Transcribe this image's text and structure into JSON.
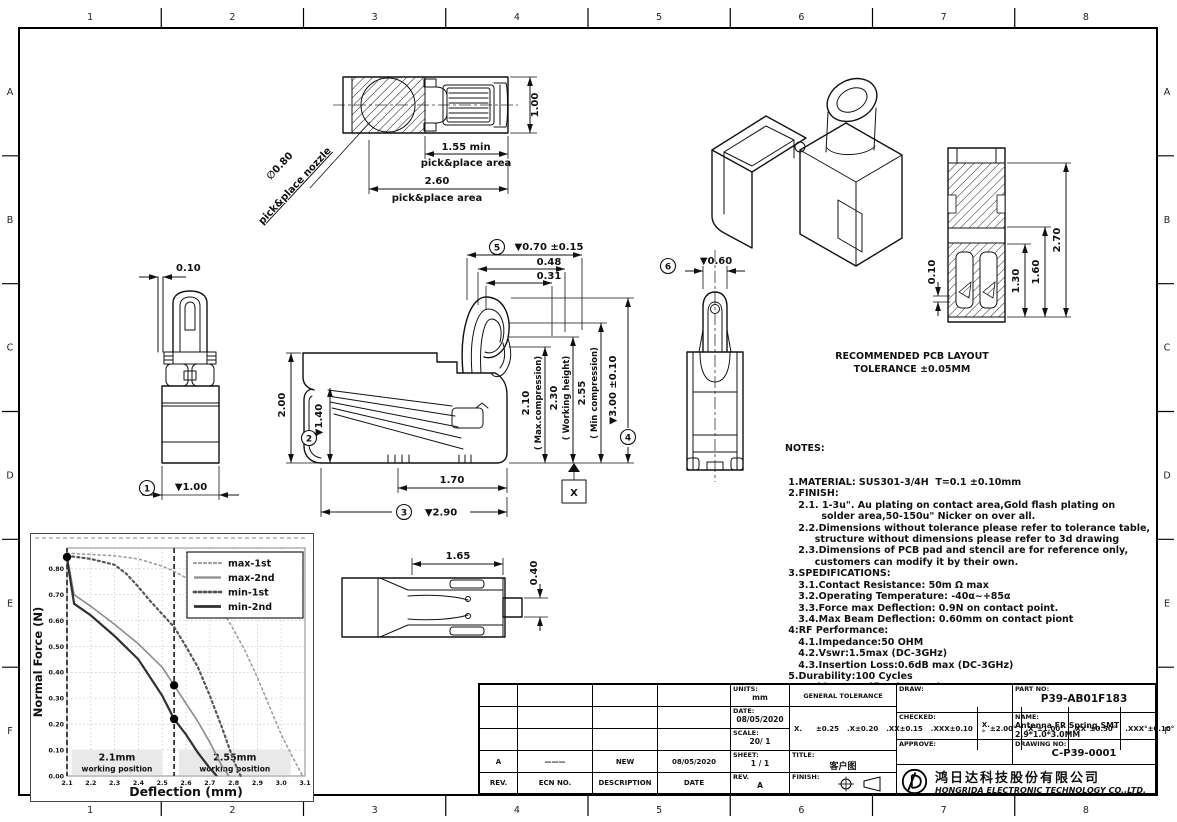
{
  "sheet": {
    "zone_cols": [
      "1",
      "2",
      "3",
      "4",
      "5",
      "6",
      "7",
      "8"
    ],
    "zone_rows": [
      "A",
      "B",
      "C",
      "D",
      "E",
      "F"
    ]
  },
  "dims": {
    "top_100": "1.00",
    "top_155": "1.55 min",
    "top_area1": "pick&place area",
    "top_260": "2.60",
    "top_area2": "pick&place area",
    "nozzle_dia": "∅0.80",
    "nozzle_label": "pick&place nozzle",
    "front_010": "0.10",
    "front_200": "2.00",
    "front_100": "▼1.00",
    "side_140": "▼1.40",
    "side_170": "1.70",
    "side_290": "▼2.90",
    "side_070": "▼0.70 ±0.15",
    "side_048": "0.48",
    "side_031": "0.31",
    "side_210": "2.10",
    "side_210n": "( Max.compression)",
    "side_230": "2.30",
    "side_230n": "( Working height)",
    "side_255": "2.55",
    "side_255n": "( Min compression)",
    "side_300": "▼3.00 ±0.10",
    "datum_x": "X",
    "back_060": "▼0.60",
    "bot_165": "1.65",
    "bot_040": "0.40",
    "pcb_010": "0.10",
    "pcb_130": "1.30",
    "pcb_160": "1.60",
    "pcb_270": "2.70",
    "b1": "1",
    "b2": "2",
    "b3": "3",
    "b4": "4",
    "b5": "5",
    "b6": "6"
  },
  "pcb_caption": {
    "line1": "RECOMMENDED PCB LAYOUT",
    "line2": "TOLERANCE ±0.05MM"
  },
  "notes": {
    "title": "NOTES:",
    "lines": [
      " 1.MATERIAL: SUS301-3/4H  T=0.1 ±0.10mm",
      " 2.FINISH:",
      "    2.1. 1-3u\". Au plating on contact area,Gold flash plating on",
      "           solder area,50-150u\" Nicker on over all.",
      "    2.2.Dimensions without tolerance please refer to tolerance table,",
      "         structure without dimensions please refer to 3d drawing",
      "    2.3.Dimensions of PCB pad and stencil are for reference only,",
      "         customers can modify it by their own.",
      " 3.SPEDIFICATIONS:",
      "    3.1.Contact Resistance: 50m Ω max",
      "    3.2.Operating Temperature: -40α~+85α",
      "    3.3.Force max Deflection: 0.9N on contact point.",
      "    3.4.Max Beam Deflection: 0.60mm on contact piont",
      " 4:RF Performance:",
      "    4.1.Impedance:50 OHM",
      "    4.2.Vswr:1.5max (DC-3GHz)",
      "    4.3.Insertion Loss:0.6dB max (DC-3GHz)",
      " 5.Durability:100 Cycles",
      " 6.Packing Specification:Reel&Tape",
      " 7.ALL DIMENSIONS MARKED ▼ MUST BE CONTROLLED BY QC."
    ]
  },
  "chart_data": {
    "type": "line",
    "title": "",
    "xlabel": "Deflection (mm)",
    "ylabel": "Normal Force (N)",
    "xlim": [
      2.1,
      3.1
    ],
    "ylim": [
      0,
      0.88
    ],
    "xticks": [
      2.1,
      2.2,
      2.3,
      2.4,
      2.5,
      2.6,
      2.7,
      2.8,
      2.9,
      3.0,
      3.1
    ],
    "yticks": [
      0,
      0.1,
      0.2,
      0.3,
      0.4,
      0.5,
      0.6,
      0.7,
      0.8
    ],
    "grid": true,
    "legend_position": "top-right",
    "series": [
      {
        "name": "max-1st",
        "line": "dotted",
        "color": "#9f9f9f",
        "width": 1.6,
        "points": [
          [
            2.1,
            0.86
          ],
          [
            2.2,
            0.855
          ],
          [
            2.3,
            0.85
          ],
          [
            2.4,
            0.838
          ],
          [
            2.5,
            0.81
          ],
          [
            2.55,
            0.79
          ],
          [
            2.6,
            0.765
          ],
          [
            2.65,
            0.745
          ],
          [
            2.7,
            0.7
          ],
          [
            2.75,
            0.645
          ],
          [
            2.8,
            0.565
          ],
          [
            2.85,
            0.48
          ],
          [
            2.9,
            0.38
          ],
          [
            2.95,
            0.27
          ],
          [
            3.0,
            0.16
          ],
          [
            3.05,
            0.07
          ],
          [
            3.09,
            0.0
          ]
        ]
      },
      {
        "name": "max-2nd",
        "line": "solid",
        "color": "#8c8c8c",
        "width": 1.6,
        "points": [
          [
            2.1,
            0.85
          ],
          [
            2.13,
            0.7
          ],
          [
            2.2,
            0.655
          ],
          [
            2.3,
            0.585
          ],
          [
            2.4,
            0.51
          ],
          [
            2.5,
            0.42
          ],
          [
            2.55,
            0.35
          ],
          [
            2.6,
            0.28
          ],
          [
            2.65,
            0.21
          ],
          [
            2.7,
            0.13
          ],
          [
            2.75,
            0.04
          ],
          [
            2.78,
            0.0
          ]
        ]
      },
      {
        "name": "min-1st",
        "line": "dotted",
        "color": "#565656",
        "width": 2.2,
        "points": [
          [
            2.1,
            0.85
          ],
          [
            2.2,
            0.838
          ],
          [
            2.3,
            0.815
          ],
          [
            2.35,
            0.78
          ],
          [
            2.4,
            0.73
          ],
          [
            2.45,
            0.675
          ],
          [
            2.5,
            0.625
          ],
          [
            2.55,
            0.575
          ],
          [
            2.6,
            0.5
          ],
          [
            2.65,
            0.42
          ],
          [
            2.7,
            0.31
          ],
          [
            2.75,
            0.19
          ],
          [
            2.8,
            0.06
          ],
          [
            2.83,
            0.0
          ]
        ]
      },
      {
        "name": "min-2nd",
        "line": "solid",
        "color": "#303030",
        "width": 2.2,
        "points": [
          [
            2.1,
            0.84
          ],
          [
            2.13,
            0.665
          ],
          [
            2.2,
            0.62
          ],
          [
            2.3,
            0.54
          ],
          [
            2.4,
            0.45
          ],
          [
            2.5,
            0.31
          ],
          [
            2.55,
            0.22
          ],
          [
            2.6,
            0.16
          ],
          [
            2.65,
            0.09
          ],
          [
            2.7,
            0.03
          ],
          [
            2.73,
            0.0
          ]
        ]
      }
    ],
    "markers": [
      [
        2.1,
        0.845
      ],
      [
        2.55,
        0.35
      ],
      [
        2.55,
        0.22
      ]
    ],
    "vlines": [
      2.1,
      2.55
    ],
    "annotations": [
      {
        "label": "2.1mm",
        "sublabel": "working position",
        "x_range": [
          2.12,
          2.5
        ]
      },
      {
        "label": "2.55mm",
        "sublabel": "working position",
        "x_range": [
          2.57,
          3.04
        ]
      }
    ]
  },
  "title_block": {
    "rev_table": {
      "headers": [
        "REV.",
        "ECN NO.",
        "DESCRIPTION",
        "DATE"
      ],
      "rows": [
        {
          "rev": "A",
          "ecn": "———",
          "description": "NEW",
          "date": "08/05/2020"
        }
      ]
    },
    "info": {
      "units_label": "UNITS:",
      "units_value": "mm",
      "date_label": "DATE:",
      "date_value": "08/05/2020",
      "scale_label": "SCALE:",
      "scale_value": "20/ 1",
      "sheet_label": "SHEET:",
      "sheet_value": "1 / 1",
      "rev_label": "REV.",
      "rev_value": "A"
    },
    "tolerance": {
      "header": "GENERAL TOLERANCE",
      "linear": [
        [
          "X.",
          "±0.25"
        ],
        [
          ".X",
          "±0.20"
        ],
        [
          ".XX",
          "±0.15"
        ],
        [
          ".XXX",
          "±0.10"
        ]
      ],
      "angular": [
        [
          "X.°",
          "±2.00°"
        ],
        [
          ".X°",
          "±1.00°"
        ],
        [
          ".XX°",
          "±0.50°"
        ],
        [
          ".XXX°",
          "±0.10°"
        ]
      ]
    },
    "title_label": "TITLE:",
    "title_value": "客户图",
    "finish_label": "FINISH:",
    "sign": {
      "draw": "DRAW:",
      "checked": "CHECKED:",
      "approve": "APPROVE:"
    },
    "part": {
      "part_no_label": "PART NO:",
      "part_no": "P39-AB01F183",
      "name_label": "NAME:",
      "name": "Antenna FR Spring,SMT 2.9*1.0*3.0MM",
      "drawing_no_label": "DRAWING NO:",
      "drawing_no": "C-P39-0001"
    },
    "company": {
      "cn": "鸿日达科技股份有限公司",
      "en": "HONGRIDA ELECTRONIC TECHNOLOGY CO.,LTD."
    }
  }
}
